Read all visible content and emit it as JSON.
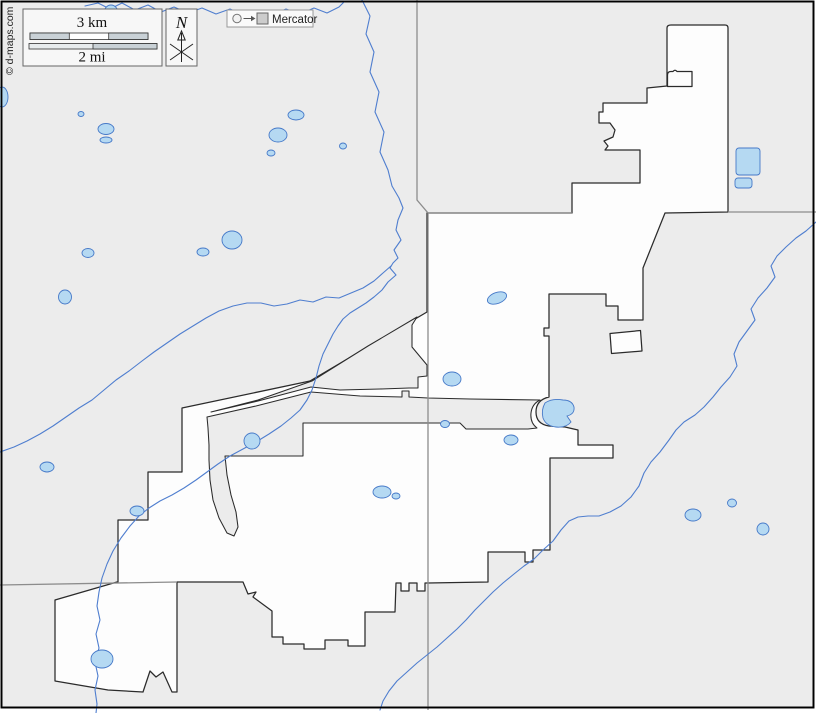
{
  "attribution": "© d-maps.com",
  "legend": {
    "projection_label": "Mercator"
  },
  "compass": {
    "north_label": "N"
  },
  "scalebar": {
    "km_label": "3 km",
    "mi_label": "2 mi"
  },
  "colors": {
    "bg": "#ececec",
    "muni": "#fdfdfd",
    "bstroke": "#2b2b2b",
    "admin": "#8c8c8c",
    "river": "#4f7ecf",
    "lakefill": "#b5d9f2",
    "lakestroke": "#4679c8",
    "frame": "#000000"
  },
  "map": {
    "rivers": [
      {
        "name": "north-river",
        "points": [
          [
            362,
            0
          ],
          [
            370,
            16
          ],
          [
            366,
            34
          ],
          [
            374,
            52
          ],
          [
            370,
            72
          ],
          [
            379,
            92
          ],
          [
            375,
            112
          ],
          [
            384,
            132
          ],
          [
            380,
            152
          ],
          [
            388,
            170
          ],
          [
            392,
            186
          ],
          [
            399,
            198
          ],
          [
            403,
            208
          ],
          [
            398,
            220
          ],
          [
            396,
            230
          ],
          [
            401,
            240
          ],
          [
            394,
            250
          ],
          [
            398,
            258
          ],
          [
            393,
            263
          ],
          [
            390,
            268
          ],
          [
            396,
            275
          ],
          [
            388,
            282
          ],
          [
            382,
            290
          ],
          [
            374,
            297
          ],
          [
            366,
            303
          ],
          [
            358,
            308
          ],
          [
            350,
            313
          ],
          [
            343,
            319
          ],
          [
            338,
            326
          ],
          [
            333,
            334
          ],
          [
            328,
            344
          ],
          [
            323,
            354
          ],
          [
            319,
            366
          ],
          [
            316,
            378
          ],
          [
            312,
            390
          ],
          [
            307,
            400
          ],
          [
            300,
            410
          ],
          [
            291,
            418
          ],
          [
            281,
            426
          ],
          [
            269,
            434
          ],
          [
            256,
            442
          ],
          [
            243,
            449
          ],
          [
            230,
            456
          ],
          [
            218,
            464
          ],
          [
            207,
            472
          ],
          [
            196,
            480
          ],
          [
            184,
            488
          ],
          [
            172,
            495
          ],
          [
            160,
            501
          ],
          [
            149,
            508
          ],
          [
            139,
            516
          ],
          [
            130,
            526
          ],
          [
            121,
            538
          ],
          [
            113,
            551
          ],
          [
            107,
            564
          ],
          [
            102,
            578
          ],
          [
            99,
            592
          ],
          [
            97,
            606
          ],
          [
            100,
            620
          ],
          [
            96,
            634
          ],
          [
            99,
            648
          ],
          [
            95,
            662
          ],
          [
            98,
            676
          ],
          [
            95,
            690
          ],
          [
            97,
            704
          ],
          [
            96,
            713
          ]
        ]
      },
      {
        "name": "west-tributary",
        "points": [
          [
            0,
            452
          ],
          [
            14,
            447
          ],
          [
            27,
            441
          ],
          [
            40,
            434
          ],
          [
            53,
            426
          ],
          [
            66,
            417
          ],
          [
            79,
            408
          ],
          [
            92,
            400
          ],
          [
            104,
            390
          ],
          [
            116,
            380
          ],
          [
            129,
            371
          ],
          [
            142,
            361
          ],
          [
            154,
            352
          ],
          [
            167,
            343
          ],
          [
            180,
            334
          ],
          [
            193,
            326
          ],
          [
            206,
            318
          ],
          [
            219,
            311
          ],
          [
            233,
            306
          ],
          [
            247,
            303
          ],
          [
            261,
            303
          ],
          [
            274,
            306
          ],
          [
            287,
            304
          ],
          [
            300,
            300
          ],
          [
            313,
            302
          ],
          [
            326,
            297
          ],
          [
            339,
            298
          ],
          [
            351,
            293
          ],
          [
            363,
            288
          ],
          [
            374,
            281
          ],
          [
            383,
            273
          ],
          [
            391,
            266
          ]
        ]
      },
      {
        "name": "top-creek",
        "points": [
          [
            85,
            6
          ],
          [
            98,
            3
          ],
          [
            110,
            9
          ],
          [
            122,
            3
          ],
          [
            135,
            10
          ],
          [
            148,
            5
          ],
          [
            161,
            12
          ],
          [
            174,
            7
          ],
          [
            188,
            13
          ],
          [
            202,
            8
          ],
          [
            216,
            14
          ],
          [
            230,
            9
          ],
          [
            244,
            15
          ],
          [
            258,
            10
          ],
          [
            272,
            15
          ],
          [
            286,
            9
          ],
          [
            300,
            14
          ],
          [
            314,
            8
          ],
          [
            327,
            13
          ],
          [
            339,
            7
          ],
          [
            345,
            1
          ]
        ]
      },
      {
        "name": "southeast-river",
        "points": [
          [
            816,
            222
          ],
          [
            806,
            231
          ],
          [
            796,
            238
          ],
          [
            786,
            247
          ],
          [
            777,
            256
          ],
          [
            771,
            266
          ],
          [
            775,
            277
          ],
          [
            767,
            288
          ],
          [
            758,
            298
          ],
          [
            751,
            309
          ],
          [
            755,
            320
          ],
          [
            747,
            331
          ],
          [
            739,
            342
          ],
          [
            734,
            354
          ],
          [
            737,
            366
          ],
          [
            730,
            377
          ],
          [
            721,
            387
          ],
          [
            713,
            397
          ],
          [
            704,
            407
          ],
          [
            695,
            415
          ],
          [
            684,
            422
          ],
          [
            676,
            430
          ],
          [
            669,
            440
          ],
          [
            660,
            452
          ],
          [
            651,
            462
          ],
          [
            644,
            473
          ],
          [
            639,
            486
          ],
          [
            631,
            497
          ],
          [
            621,
            506
          ],
          [
            610,
            512
          ],
          [
            599,
            516
          ],
          [
            588,
            516
          ],
          [
            578,
            517
          ],
          [
            569,
            521
          ],
          [
            561,
            530
          ],
          [
            553,
            541
          ],
          [
            543,
            550
          ],
          [
            534,
            559
          ],
          [
            524,
            566
          ],
          [
            514,
            574
          ],
          [
            503,
            583
          ],
          [
            493,
            592
          ],
          [
            484,
            601
          ],
          [
            475,
            610
          ],
          [
            466,
            620
          ],
          [
            457,
            629
          ],
          [
            447,
            638
          ],
          [
            437,
            647
          ],
          [
            427,
            655
          ],
          [
            417,
            663
          ],
          [
            407,
            672
          ],
          [
            397,
            681
          ],
          [
            389,
            691
          ],
          [
            383,
            701
          ],
          [
            380,
            710
          ]
        ]
      }
    ],
    "lakes": [
      {
        "cx": 111,
        "cy": 13,
        "rx": 7,
        "ry": 8
      },
      {
        "cx": 2,
        "cy": 97,
        "rx": 6,
        "ry": 10
      },
      {
        "cx": 81,
        "cy": 114,
        "rx": 3,
        "ry": 2.5
      },
      {
        "cx": 106,
        "cy": 129,
        "rx": 8,
        "ry": 5.5
      },
      {
        "cx": 106,
        "cy": 140,
        "rx": 6,
        "ry": 3
      },
      {
        "cx": 296,
        "cy": 115,
        "rx": 8,
        "ry": 5
      },
      {
        "cx": 278,
        "cy": 135,
        "rx": 9,
        "ry": 7
      },
      {
        "cx": 271,
        "cy": 153,
        "rx": 4,
        "ry": 3
      },
      {
        "cx": 343,
        "cy": 146,
        "rx": 3.5,
        "ry": 3
      },
      {
        "rect": [
          736,
          148,
          24,
          27
        ]
      },
      {
        "rect": [
          735,
          178,
          17,
          10
        ]
      },
      {
        "cx": 232,
        "cy": 240,
        "rx": 10,
        "ry": 9
      },
      {
        "cx": 203,
        "cy": 252,
        "rx": 6,
        "ry": 4
      },
      {
        "cx": 88,
        "cy": 253,
        "rx": 6,
        "ry": 4.5
      },
      {
        "cx": 65,
        "cy": 297,
        "rx": 6.5,
        "ry": 7
      },
      {
        "cx": 497,
        "cy": 298,
        "rx": 10,
        "ry": 5.5,
        "rot": -20
      },
      {
        "cx": 452,
        "cy": 379,
        "rx": 9,
        "ry": 7
      },
      {
        "path": "M 545,403 Q 541,410 543,418 Q 546,426 556,427 Q 566,428 571,422 L 567,416 Q 575,414 574,407 Q 572,400 563,400 Q 552,398 545,403 Z"
      },
      {
        "cx": 47,
        "cy": 467,
        "rx": 7,
        "ry": 5
      },
      {
        "cx": 137,
        "cy": 511,
        "rx": 7,
        "ry": 5
      },
      {
        "cx": 252,
        "cy": 441,
        "rx": 8,
        "ry": 8
      },
      {
        "cx": 382,
        "cy": 492,
        "rx": 9,
        "ry": 6
      },
      {
        "cx": 396,
        "cy": 496,
        "rx": 4,
        "ry": 3
      },
      {
        "cx": 511,
        "cy": 440,
        "rx": 7,
        "ry": 5
      },
      {
        "cx": 693,
        "cy": 515,
        "rx": 8,
        "ry": 6
      },
      {
        "cx": 732,
        "cy": 503,
        "rx": 4.5,
        "ry": 4
      },
      {
        "cx": 763,
        "cy": 529,
        "rx": 6,
        "ry": 6
      },
      {
        "cx": 102,
        "cy": 659,
        "rx": 11,
        "ry": 9
      },
      {
        "cx": 445,
        "cy": 424,
        "rx": 4.5,
        "ry": 3.5
      }
    ]
  }
}
